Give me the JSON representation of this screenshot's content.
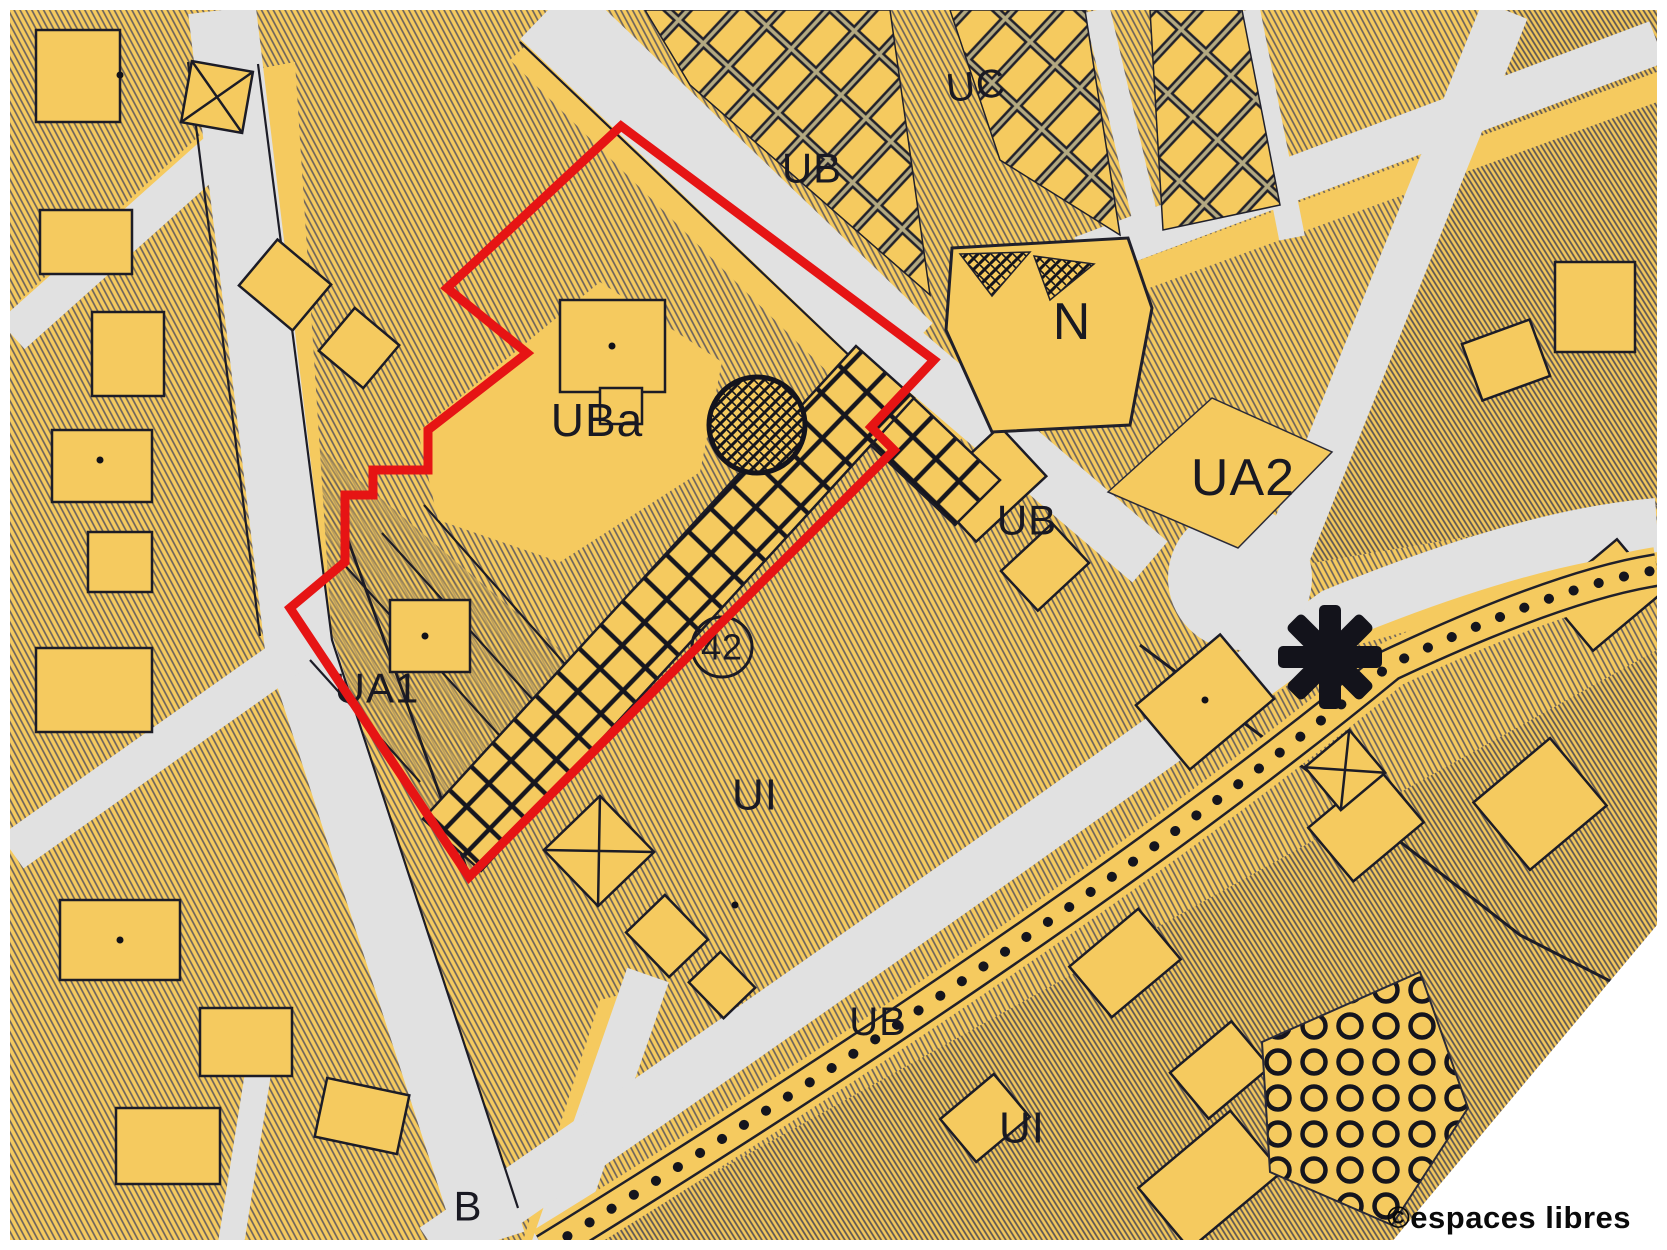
{
  "map": {
    "kind": "urban-zoning-plan",
    "watermark": "©espaces libres",
    "zone_labels": [
      {
        "text": "UC",
        "x": 976,
        "y": 86,
        "size": 40,
        "rotate": -6
      },
      {
        "text": "UB",
        "x": 812,
        "y": 168,
        "size": 42,
        "rotate": 0
      },
      {
        "text": "N",
        "x": 1072,
        "y": 322,
        "size": 52,
        "rotate": 0
      },
      {
        "text": "UA2",
        "x": 1243,
        "y": 478,
        "size": 52,
        "rotate": 0
      },
      {
        "text": "UB",
        "x": 1027,
        "y": 520,
        "size": 42,
        "rotate": 0
      },
      {
        "text": "UBa",
        "x": 597,
        "y": 420,
        "size": 46,
        "rotate": 0
      },
      {
        "text": "UA1",
        "x": 377,
        "y": 688,
        "size": 42,
        "rotate": 0
      },
      {
        "text": "42",
        "x": 722,
        "y": 647,
        "size": 36,
        "rotate": 0
      },
      {
        "text": "UI",
        "x": 755,
        "y": 795,
        "size": 44,
        "rotate": 0
      },
      {
        "text": "UB",
        "x": 878,
        "y": 1022,
        "size": 40,
        "rotate": 0
      },
      {
        "text": "UI",
        "x": 1022,
        "y": 1128,
        "size": 44,
        "rotate": 0
      },
      {
        "text": "B",
        "x": 468,
        "y": 1206,
        "size": 42,
        "rotate": 0
      }
    ],
    "symbols": [
      {
        "name": "monument-circle-icon",
        "x": 757,
        "y": 425,
        "r": 48
      },
      {
        "name": "reserved-site-42-circle",
        "x": 722,
        "y": 647,
        "r": 30
      },
      {
        "name": "star-marker-icon",
        "x": 1330,
        "y": 657,
        "size": 104
      }
    ],
    "highlight_outline": {
      "color": "#e61414",
      "points": "621,126 934,360 871,427 894,450 759,585 469,877 290,608 345,562 345,495 373,495 373,470 428,470 428,430 527,353 447,288"
    },
    "colors": {
      "paper": "#ffffff",
      "parcel_yellow": "#f5ca5f",
      "street_gray": "#e1e1e1",
      "ink": "#1a1a22",
      "hatch_line": "#4b4b5e",
      "highlight_red": "#e61414"
    }
  }
}
